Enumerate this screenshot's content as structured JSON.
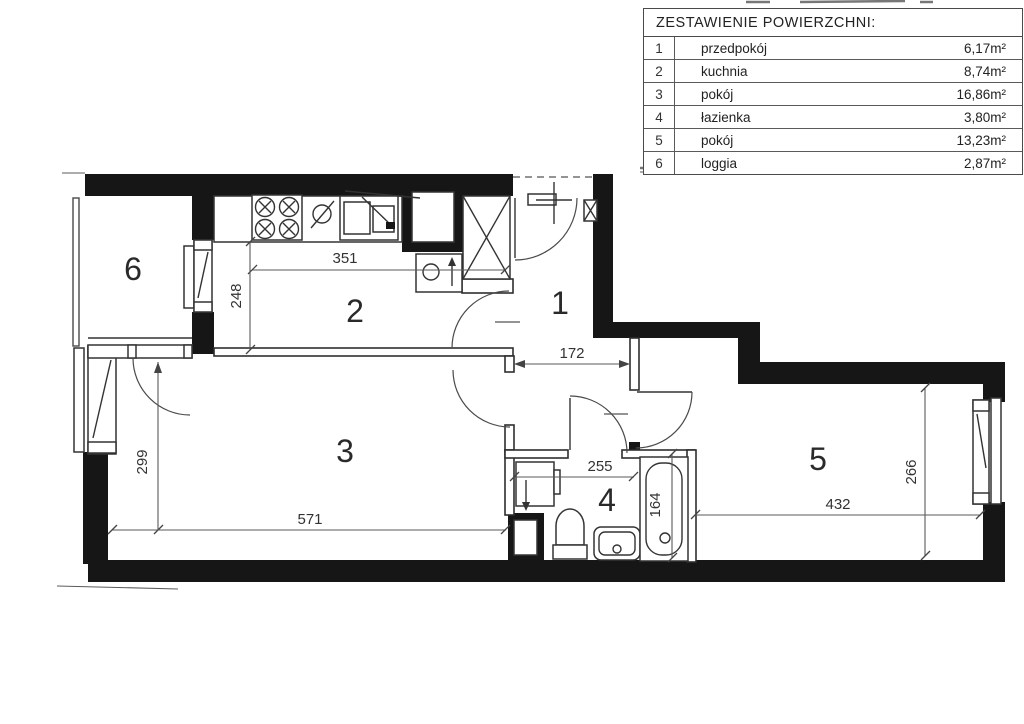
{
  "legend": {
    "title": "ZESTAWIENIE POWIERZCHNI:",
    "rows": [
      {
        "no": "1",
        "name": "przedpokój",
        "area": "6,17m²"
      },
      {
        "no": "2",
        "name": "kuchnia",
        "area": "8,74m²"
      },
      {
        "no": "3",
        "name": "pokój",
        "area": "16,86m²"
      },
      {
        "no": "4",
        "name": "łazienka",
        "area": "3,80m²"
      },
      {
        "no": "5",
        "name": "pokój",
        "area": "13,23m²"
      },
      {
        "no": "6",
        "name": "loggia",
        "area": "2,87m²"
      }
    ]
  },
  "plan": {
    "room_labels": {
      "hall": "1",
      "kitchen": "2",
      "room3": "3",
      "bathroom": "4",
      "room5": "5",
      "loggia": "6"
    },
    "dimensions": {
      "kitchen_width": "351",
      "kitchen_depth": "248",
      "hall_width": "172",
      "room3_depth": "299",
      "room3_width": "571",
      "bath_width": "255",
      "tub_length": "164",
      "room5_width": "432",
      "room5_depth": "266"
    },
    "wall_color": "#161616"
  }
}
